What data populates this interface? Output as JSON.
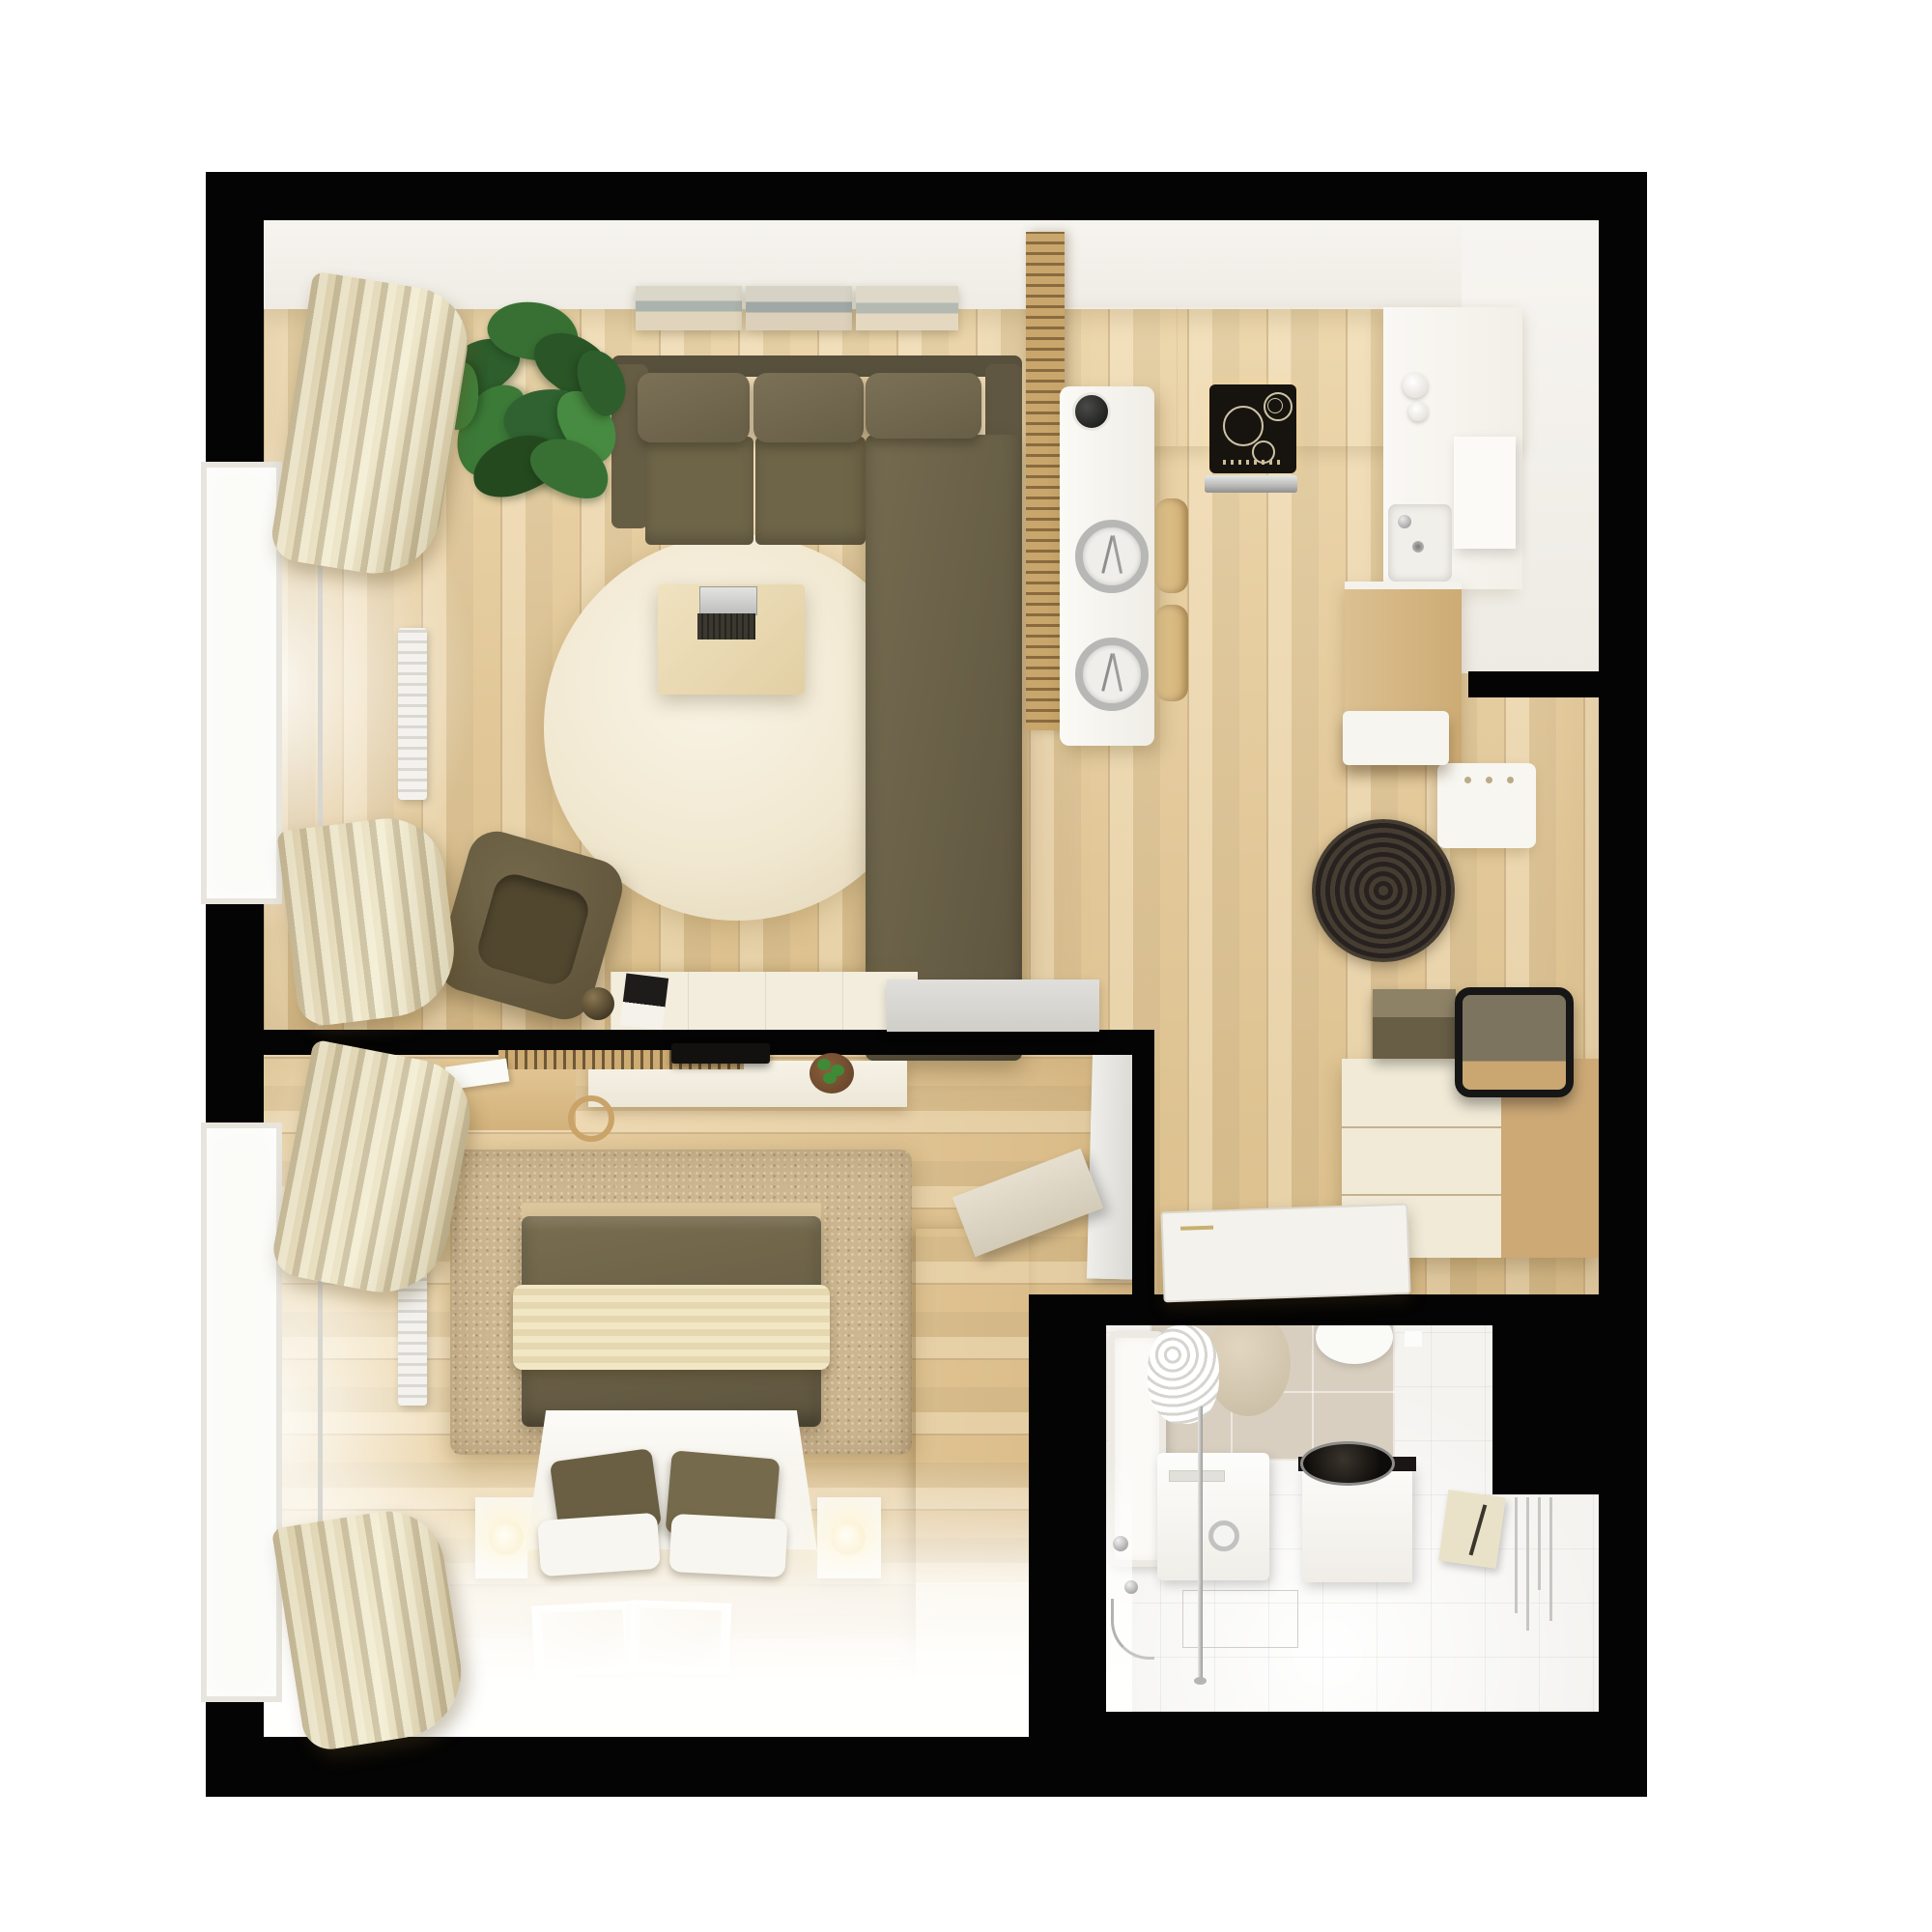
{
  "meta": {
    "title": "Studio apartment floor plan — top-down 3D render",
    "view": "top-down orthographic render",
    "background": "#ffffff"
  },
  "palette": {
    "wall_black": "#040404",
    "wood_floor": "#e5cda2",
    "wood_plank_line": "#92683a",
    "bedroom_carpet": "#cdb68f",
    "living_rug_cream": "#f1e8d1",
    "hallway_rug_dark": "#2f2923",
    "sofa_olive": "#6e654a",
    "bed_olive": "#6b6148",
    "throw_cream": "#ecdfb9",
    "curtain_beige": "#d9cca9",
    "counter_white": "#f8f6f1",
    "cabinet_cream": "#f1ead7",
    "cabinet_wood": "#cda976",
    "tile_beige": "#d9cfc0",
    "bath_floor_white": "#f4f3f0",
    "plant_green": "#3c7a38",
    "chrome": "#b7b8b6",
    "hob_black": "#17140f"
  },
  "rooms": {
    "living": {
      "label": "living room"
    },
    "kitchen": {
      "label": "kitchen"
    },
    "hallway": {
      "label": "hallway / entry"
    },
    "bedroom": {
      "label": "bedroom"
    },
    "bathroom": {
      "label": "bathroom"
    }
  },
  "items": {
    "sofa": {
      "label": "olive corner sofa with chaise",
      "color": "#6e654a"
    },
    "round_rug": {
      "label": "round cream rug",
      "color": "#f1e8d1"
    },
    "coffee_table": {
      "label": "coffee table with open laptop"
    },
    "armchair": {
      "label": "olive swivel armchair",
      "color": "#5c5138"
    },
    "ball_lamp": {
      "label": "bronze ball floor lamp"
    },
    "plant": {
      "label": "large potted ficus plant",
      "color": "#3c7a38"
    },
    "wall_art": {
      "label": "three-panel panoramic wall art"
    },
    "sideboard": {
      "label": "cream sideboard with magazine"
    },
    "curtains": {
      "label": "beige curtains on rod"
    },
    "window": {
      "label": "window with white frame"
    },
    "radiator": {
      "label": "white wall radiator"
    },
    "slat_partition": {
      "label": "wood slat partition",
      "color": "#c9a66b"
    },
    "bar_counter": {
      "label": "white bar counter with two place settings"
    },
    "bar_stools": {
      "label": "two wooden bar stools"
    },
    "coffee_maker": {
      "label": "black coffee maker"
    },
    "hob": {
      "label": "black induction hob with burners"
    },
    "oven": {
      "label": "stainless oven front"
    },
    "kitchen_sink": {
      "label": "kitchen sink with chrome faucet"
    },
    "tall_cabinet": {
      "label": "tall wood kitchen cabinet"
    },
    "nook_wardrobe": {
      "label": "white cabinet in kitchen nook"
    },
    "coat_rack": {
      "label": "white coat rack panel with hooks"
    },
    "shoe_bench": {
      "label": "white shoe bench"
    },
    "dark_rug": {
      "label": "round dark braided rug",
      "color": "#2f2923"
    },
    "dresser": {
      "label": "cream and wood hallway dresser"
    },
    "storage_box": {
      "label": "olive storage box on dresser",
      "color": "#685e46"
    },
    "mirror": {
      "label": "black-framed leaning mirror"
    },
    "open_door": {
      "label": "open grey interior door"
    },
    "leaning_door": {
      "label": "beige door leaf leaning"
    },
    "flat_door": {
      "label": "white door leaf lying at bathroom threshold"
    },
    "bed": {
      "label": "double bed with olive duvet, cream throw, pillows",
      "color": "#6b6148"
    },
    "nightstands": {
      "label": "two white nightstands with glowing sphere lamps"
    },
    "bedroom_rug": {
      "label": "textured beige bedroom rug",
      "color": "#cdb68f"
    },
    "tv": {
      "label": "wall-mounted TV"
    },
    "media_console": {
      "label": "white media console with small plant"
    },
    "slat_rail": {
      "label": "wood slat hanger rail"
    },
    "desk": {
      "label": "wood desk with papers and chair"
    },
    "wardrobe": {
      "label": "tall wood wardrobe",
      "color": "#bf9a66"
    },
    "floor_pictures": {
      "label": "two framed prints on floor"
    },
    "bathtub": {
      "label": "white bathtub with chrome mixer and hose"
    },
    "shower_curtain": {
      "label": "crumpled white shower curtain"
    },
    "stone_stool": {
      "label": "round stone stool",
      "color": "#c6baa2"
    },
    "toilet": {
      "label": "wall-hung toilet"
    },
    "washing_machine": {
      "label": "washing machine with chrome dial"
    },
    "vanity": {
      "label": "vanity with round dark vessel basin",
      "color": "#0e0c0a"
    },
    "glass_panel": {
      "label": "reflective glass panel on floor"
    },
    "curtain_pole": {
      "label": "floor-to-ceiling chrome pole"
    },
    "towel_box": {
      "label": "cream towel holder box"
    },
    "towel_radiator": {
      "label": "chrome towel radiator"
    }
  }
}
